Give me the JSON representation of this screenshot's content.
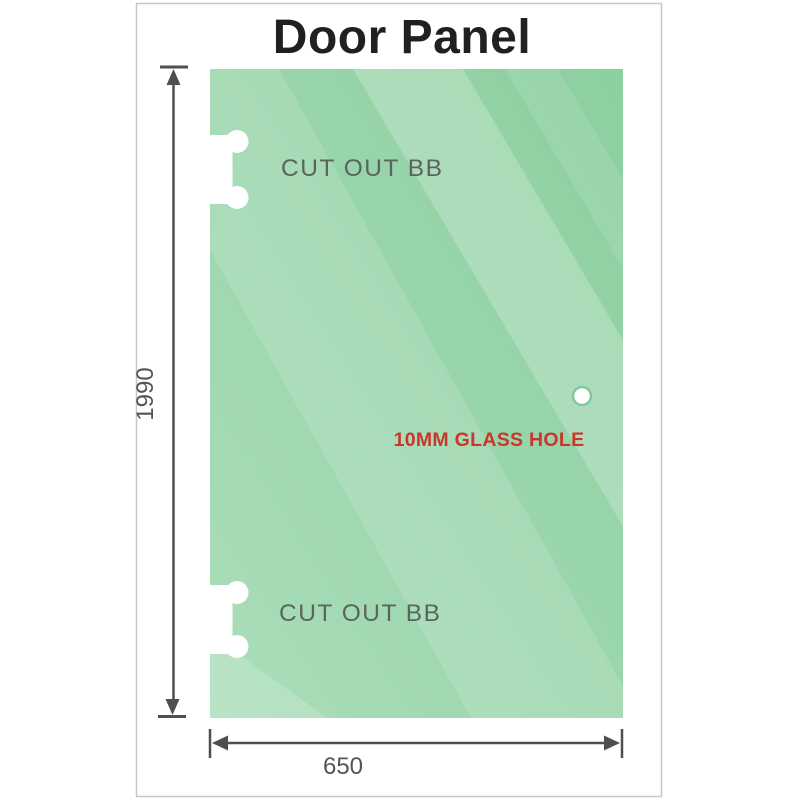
{
  "page": {
    "title": "Door Panel",
    "background_color": "#ffffff",
    "card_border_color": "#c8c8c8",
    "title_color": "#202020"
  },
  "panel": {
    "glass_gradient_start": "#8ccfa0",
    "glass_gradient_end": "#aaddb9",
    "streak_color": "#ffffff",
    "cutout_top_label": "CUT OUT BB",
    "cutout_bottom_label": "CUT OUT BB",
    "cutout_label_color": "#5a655e",
    "cutout_fill": "#ffffff",
    "hole_label": "10MM GLASS HOLE",
    "hole_label_color": "#c9362c",
    "hole_fill": "#ffffff",
    "hole_ring_color": "#84c79b"
  },
  "dimensions": {
    "height_value": "1990",
    "width_value": "650",
    "text_color": "#555555",
    "line_color": "#4f4f4f"
  },
  "icons": {
    "arrow_up_icon": "▲",
    "arrow_down_icon": "▼",
    "arrow_left_icon": "◀",
    "arrow_right_icon": "▶"
  }
}
